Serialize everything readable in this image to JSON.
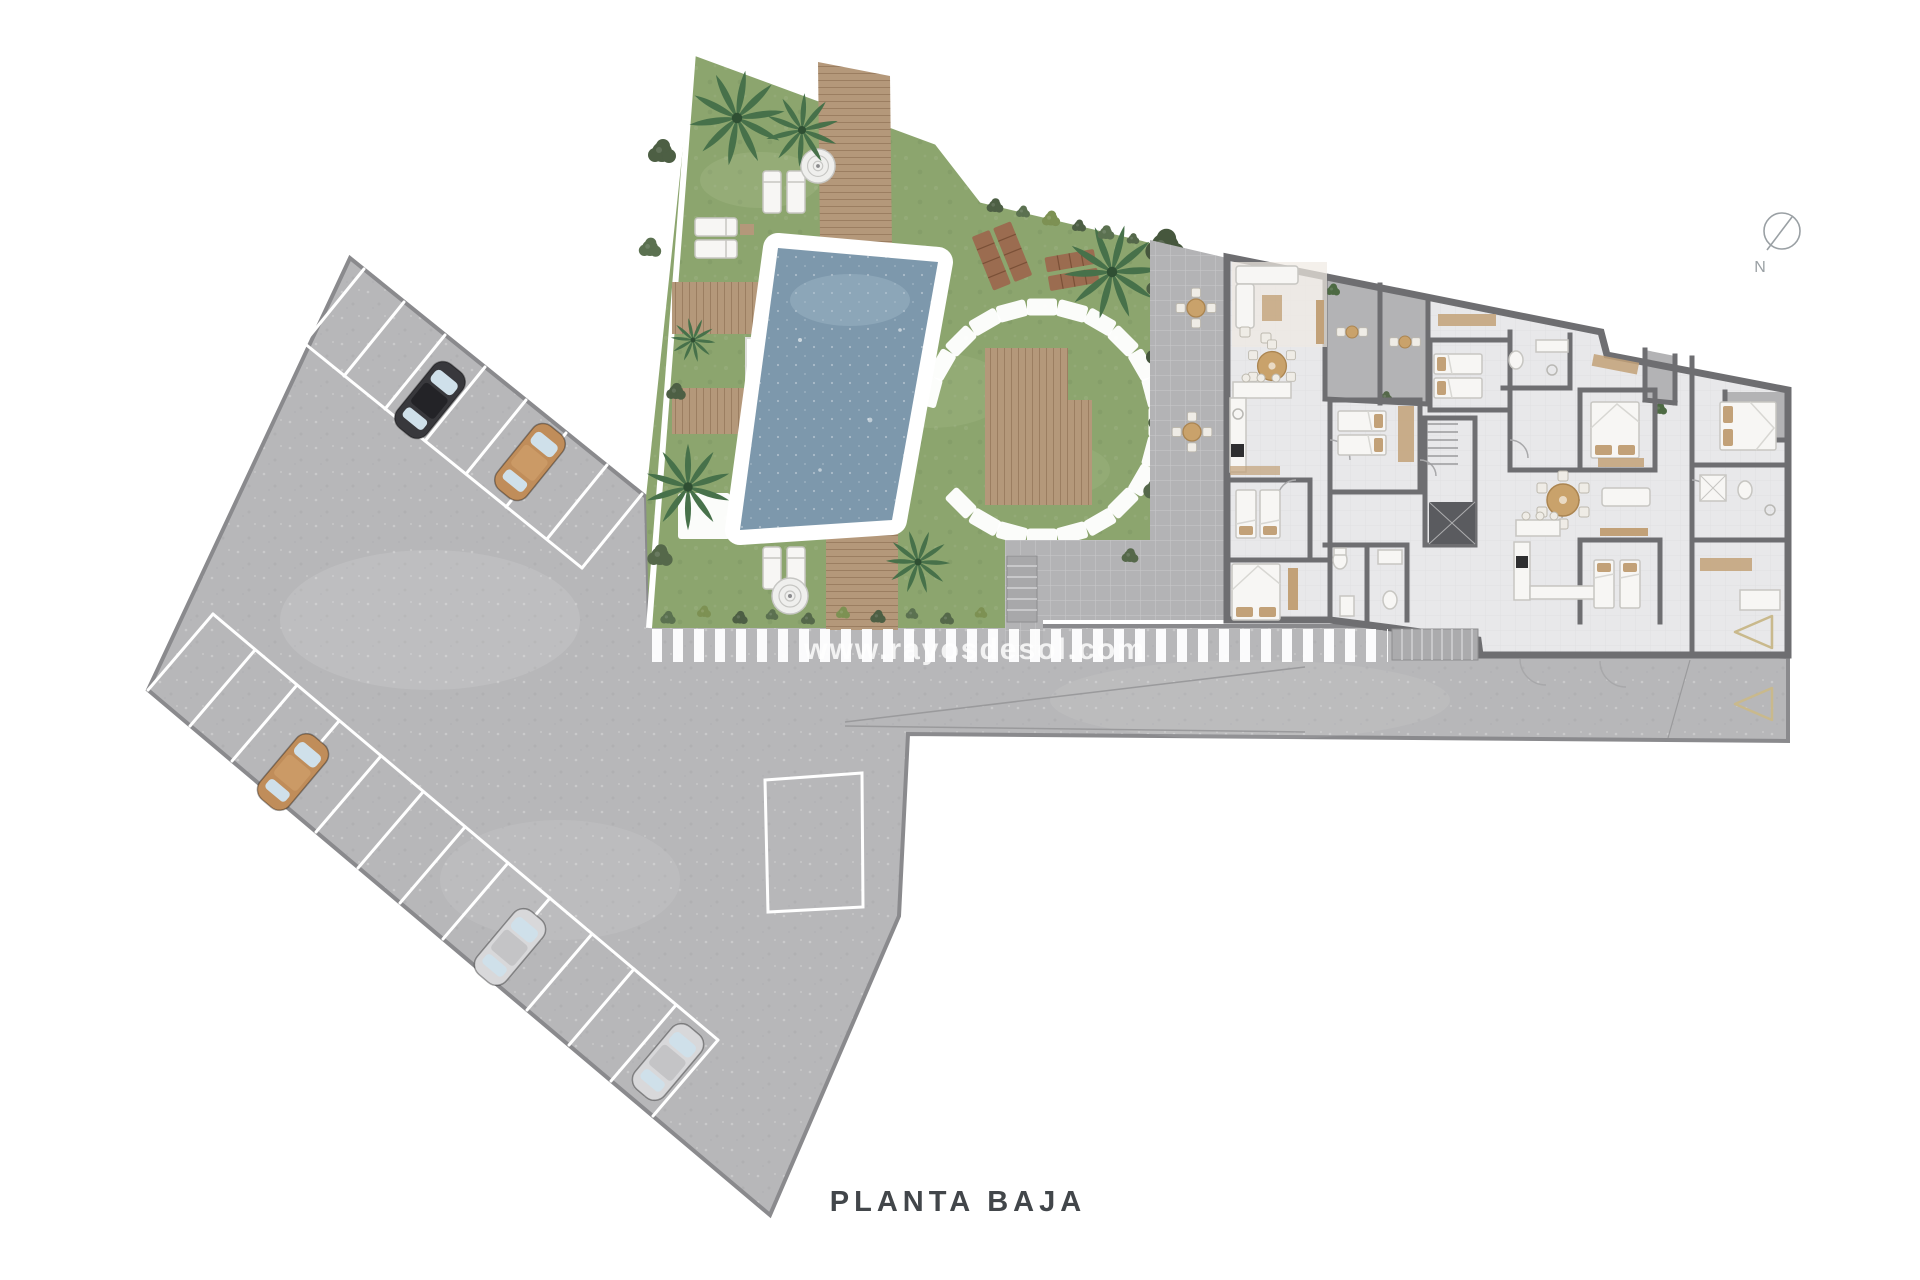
{
  "plan": {
    "title": "PLANTA BAJA",
    "compass_label": "N",
    "watermark": "www.rayosdesol.com"
  },
  "colors": {
    "pavement": "#b7b7b9",
    "pavement-border": "#8a8a8d",
    "line-white": "#ffffff",
    "grass": "#8ca56e",
    "garden-border": "#ffffff",
    "pool-water": "#7d98ac",
    "wood": "#b4987a",
    "wood-dark": "#9b6c50",
    "wall": "#6e6e71",
    "floor": "#e8e8ea",
    "terrace": "#b3b3b5",
    "furniture": "#f7f6f4",
    "furniture-stroke": "#c7c6c2",
    "pillow": "#c2a178",
    "counter-dark": "#2e2e30",
    "hedge": "#53654a",
    "palm": "#47714a",
    "car-black": "#38383c",
    "car-tan": "#c08d5a",
    "car-silver": "#d8d8da",
    "car-window": "#cfe0ea",
    "marker": "#c9b98c",
    "compass": "#9aa0a4",
    "title": "#42464a",
    "watermark-color": "#ffffff"
  }
}
